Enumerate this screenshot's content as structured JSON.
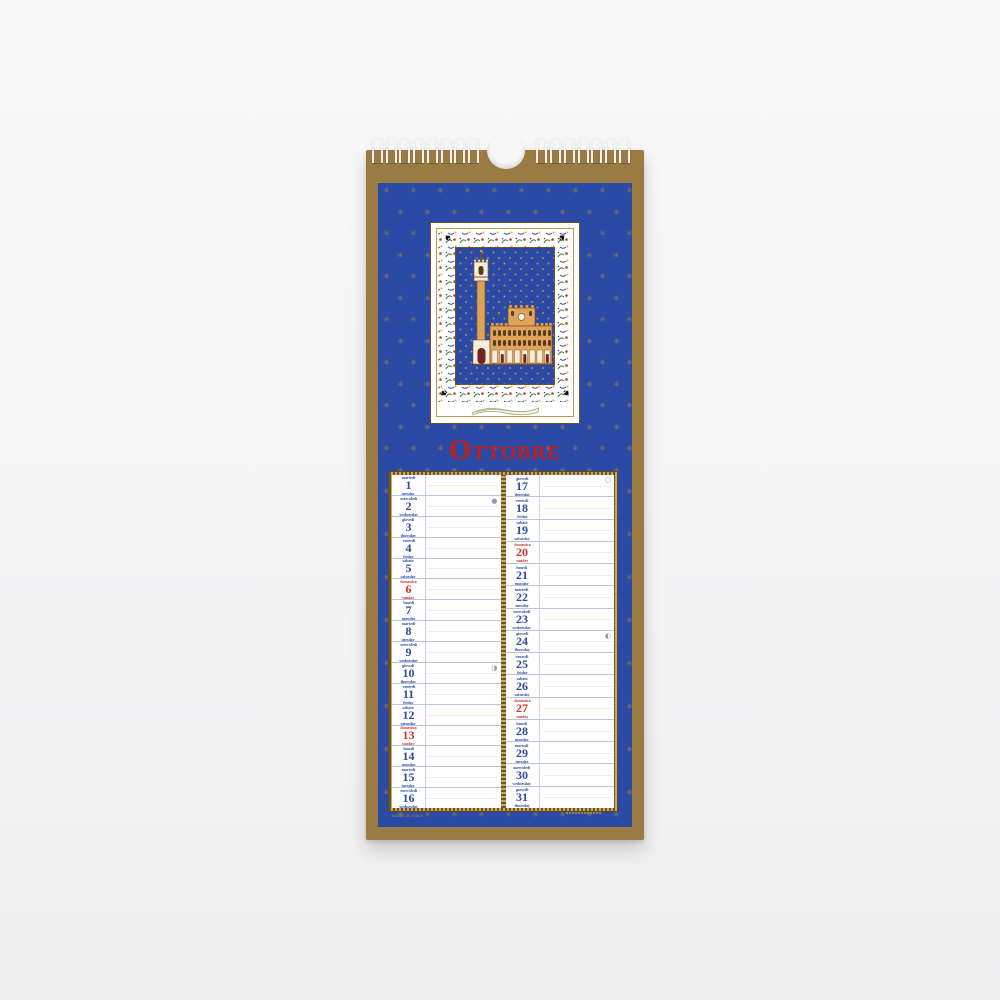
{
  "calendar": {
    "title": "Ottobre",
    "fine_print": "MADE IN ITALY",
    "colors": {
      "board_gold": "#9a7b44",
      "panel_blue": "#2b4aa6",
      "title_red": "#c0201d",
      "weekday_blue": "#2c4b9f",
      "sunday_red": "#d22f2a",
      "star_gold": "#a08140"
    },
    "icons": {
      "binding": "spiral-binding",
      "hanger": "hanger-notch",
      "stars": "gold-star-pattern",
      "illustration": "siena-palazzo-pubblico-with-torre-del-mangia",
      "banner": "scroll-banner"
    },
    "moon_phases": {
      "new": "●",
      "first_quarter": "◑",
      "full": "○",
      "last_quarter": "◐"
    },
    "columns": [
      {
        "days": [
          {
            "n": "1",
            "it": "martedì",
            "en": "tuesday"
          },
          {
            "n": "2",
            "it": "mercoledì",
            "en": "wednesday",
            "moon": "new"
          },
          {
            "n": "3",
            "it": "giovedì",
            "en": "thursday"
          },
          {
            "n": "4",
            "it": "venerdì",
            "en": "friday"
          },
          {
            "n": "5",
            "it": "sabato",
            "en": "saturday"
          },
          {
            "n": "6",
            "it": "domenica",
            "en": "sunday",
            "sunday": true
          },
          {
            "n": "7",
            "it": "lunedì",
            "en": "monday"
          },
          {
            "n": "8",
            "it": "martedì",
            "en": "tuesday"
          },
          {
            "n": "9",
            "it": "mercoledì",
            "en": "wednesday"
          },
          {
            "n": "10",
            "it": "giovedì",
            "en": "thursday",
            "moon": "first_quarter"
          },
          {
            "n": "11",
            "it": "venerdì",
            "en": "friday"
          },
          {
            "n": "12",
            "it": "sabato",
            "en": "saturday"
          },
          {
            "n": "13",
            "it": "domenica",
            "en": "sunday",
            "sunday": true
          },
          {
            "n": "14",
            "it": "lunedì",
            "en": "monday"
          },
          {
            "n": "15",
            "it": "martedì",
            "en": "tuesday"
          },
          {
            "n": "16",
            "it": "mercoledì",
            "en": "wednesday"
          }
        ]
      },
      {
        "days": [
          {
            "n": "17",
            "it": "giovedì",
            "en": "thursday",
            "moon": "full"
          },
          {
            "n": "18",
            "it": "venerdì",
            "en": "friday"
          },
          {
            "n": "19",
            "it": "sabato",
            "en": "saturday"
          },
          {
            "n": "20",
            "it": "domenica",
            "en": "sunday",
            "sunday": true
          },
          {
            "n": "21",
            "it": "lunedì",
            "en": "monday"
          },
          {
            "n": "22",
            "it": "martedì",
            "en": "tuesday"
          },
          {
            "n": "23",
            "it": "mercoledì",
            "en": "wednesday"
          },
          {
            "n": "24",
            "it": "giovedì",
            "en": "thursday",
            "moon": "last_quarter"
          },
          {
            "n": "25",
            "it": "venerdì",
            "en": "friday"
          },
          {
            "n": "26",
            "it": "sabato",
            "en": "saturday"
          },
          {
            "n": "27",
            "it": "domenica",
            "en": "sunday",
            "sunday": true
          },
          {
            "n": "28",
            "it": "lunedì",
            "en": "monday"
          },
          {
            "n": "29",
            "it": "martedì",
            "en": "tuesday"
          },
          {
            "n": "30",
            "it": "mercoledì",
            "en": "wednesday"
          },
          {
            "n": "31",
            "it": "giovedì",
            "en": "thursday"
          }
        ]
      }
    ]
  }
}
